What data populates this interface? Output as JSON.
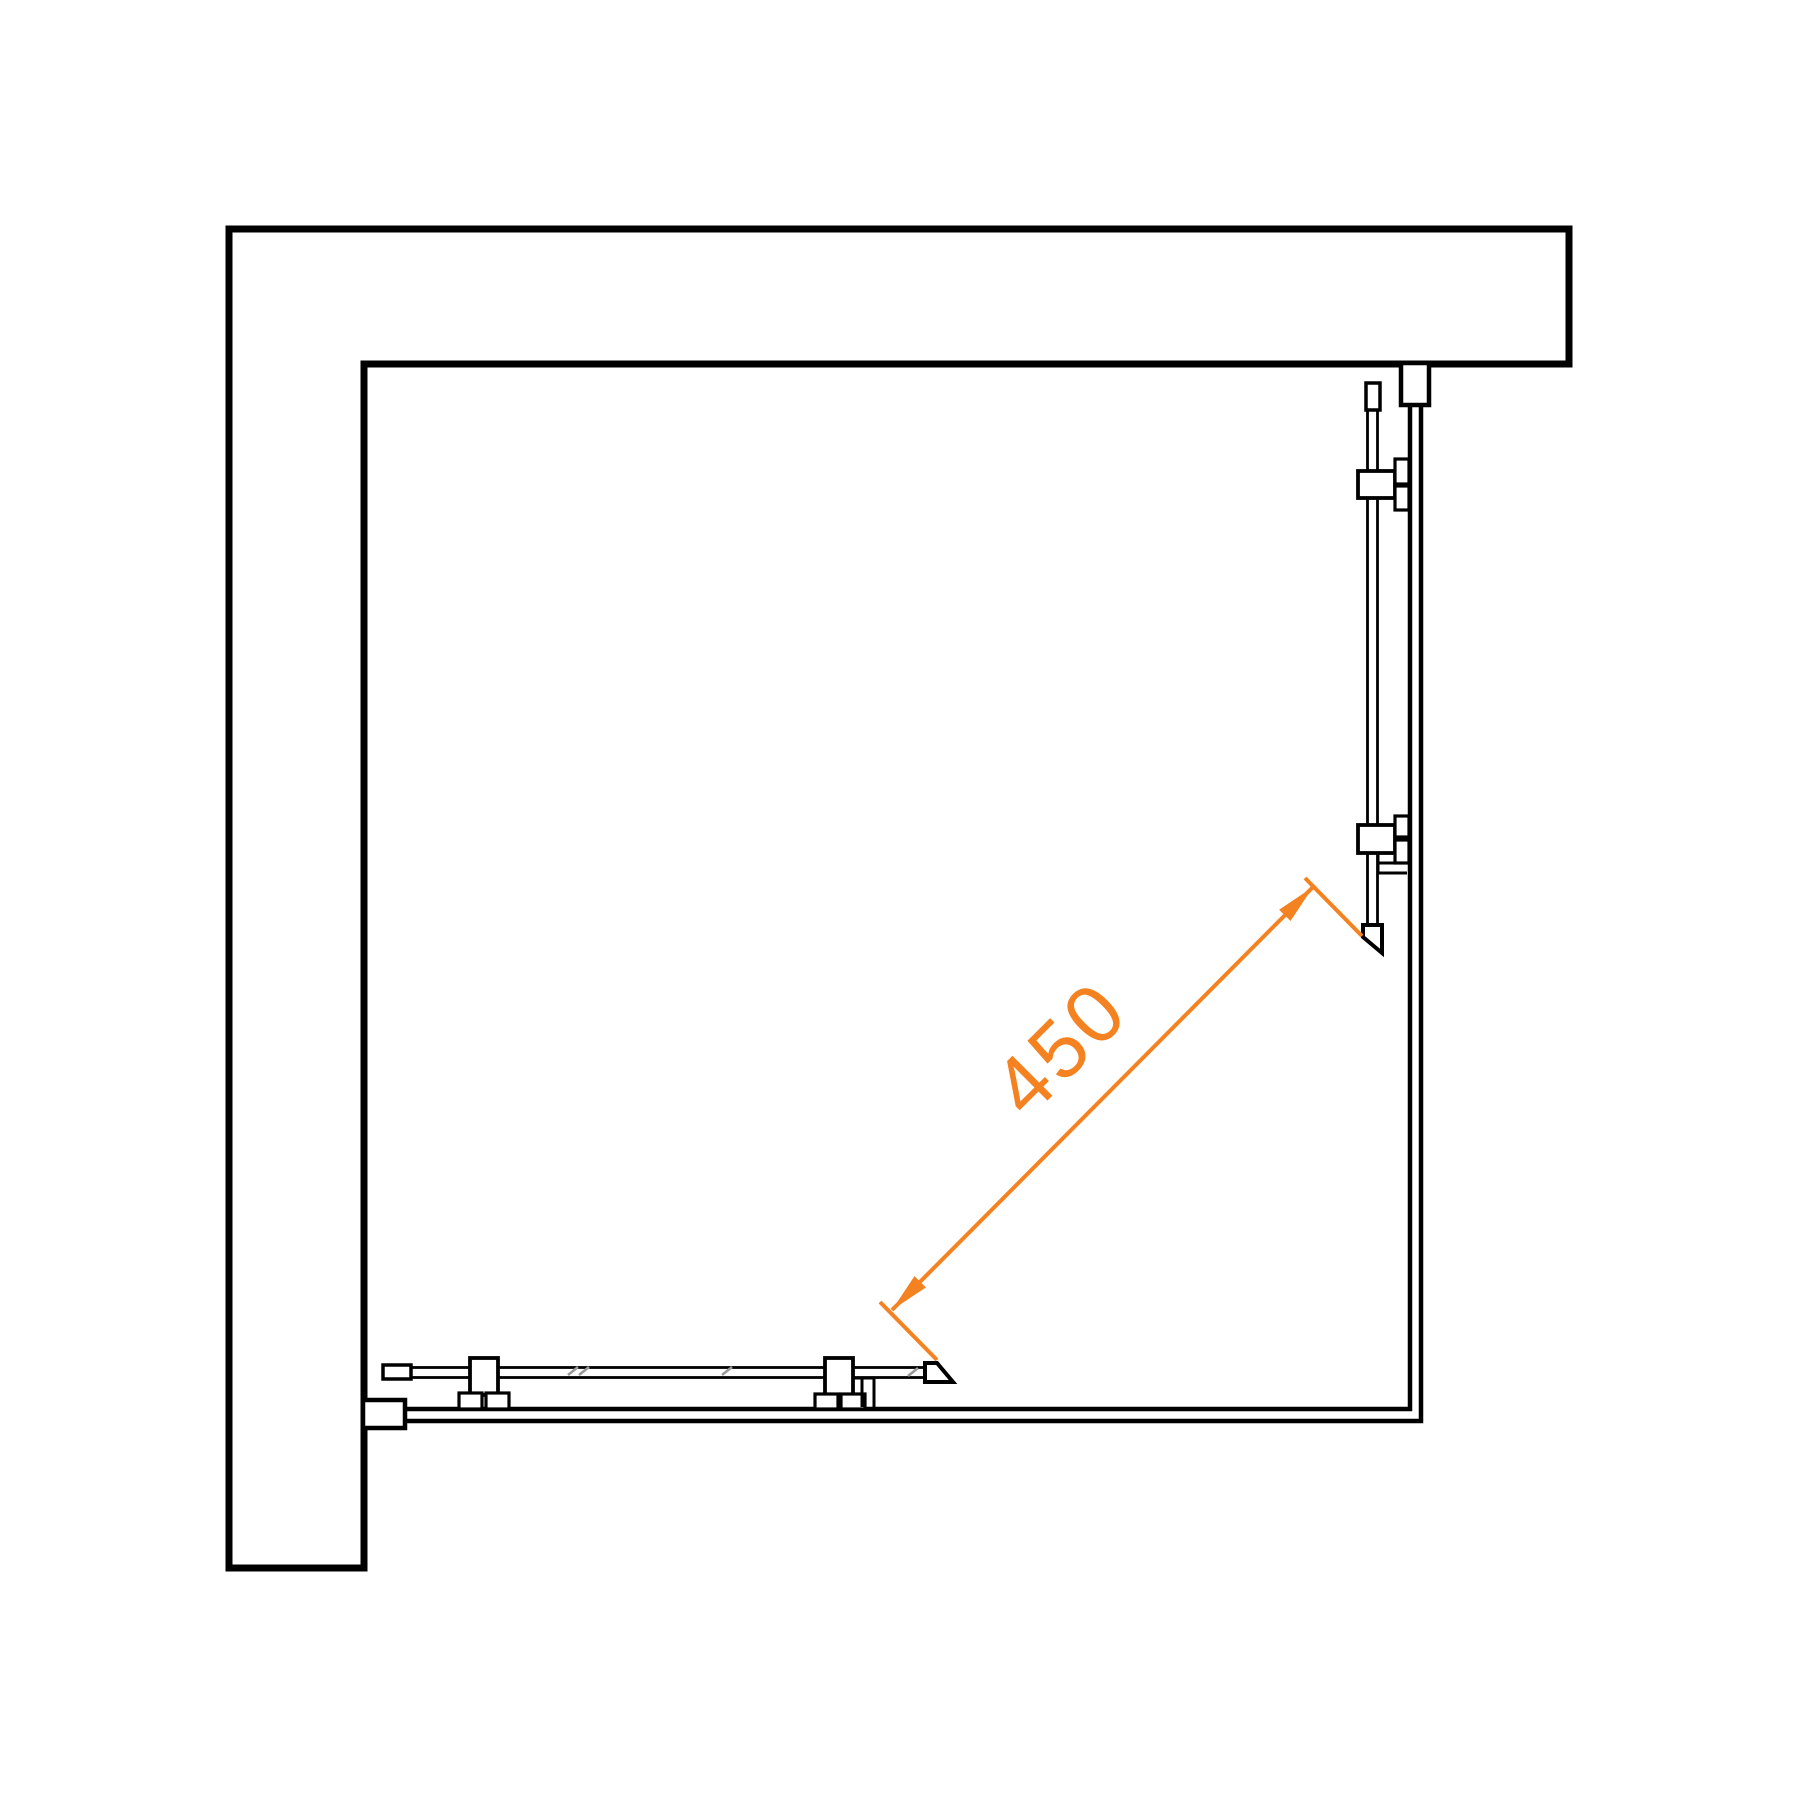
{
  "drawing": {
    "type": "shower-enclosure-corner-entry-plan-view",
    "background": "#ffffff",
    "line_color": "#000000",
    "hatch_color": "#9a9a9a",
    "dimension": {
      "label": "450",
      "value": 450,
      "color": "#F58220",
      "line": {
        "x1": 892,
        "y1": 1310,
        "x2": 1313,
        "y2": 887
      },
      "witness_top": {
        "x1": 1305,
        "y1": 878,
        "x2": 1362,
        "y2": 936
      },
      "witness_bottom": {
        "x1": 880,
        "y1": 1302,
        "x2": 937,
        "y2": 1360
      },
      "label_font_size": 82,
      "label_rotation_deg": -45
    },
    "wall": {
      "shape": "L",
      "outer_corner": {
        "x": 229,
        "y": 229
      },
      "inner_corner": {
        "x": 364,
        "y": 364
      },
      "top_wall_right_end_x": 1569,
      "left_wall_bottom_end_y": 1568
    },
    "frame": {
      "inner_corner": {
        "x": 1410,
        "y": 1409
      },
      "outer_corner": {
        "x": 1421,
        "y": 1421
      },
      "starts_at": 405
    },
    "doors": [
      {
        "name": "right-sliding-door",
        "orientation": "vertical",
        "glass_span": {
          "from": 410,
          "to": 925
        },
        "end_cap": "top",
        "handle": "bottom",
        "rollers": 2
      },
      {
        "name": "bottom-sliding-door",
        "orientation": "horizontal",
        "glass_span": {
          "from": 411,
          "to": 925
        },
        "end_cap": "left",
        "handle": "right",
        "rollers": 2,
        "glass_hatch_marks_x": [
          568,
          579,
          722,
          908
        ]
      }
    ]
  }
}
